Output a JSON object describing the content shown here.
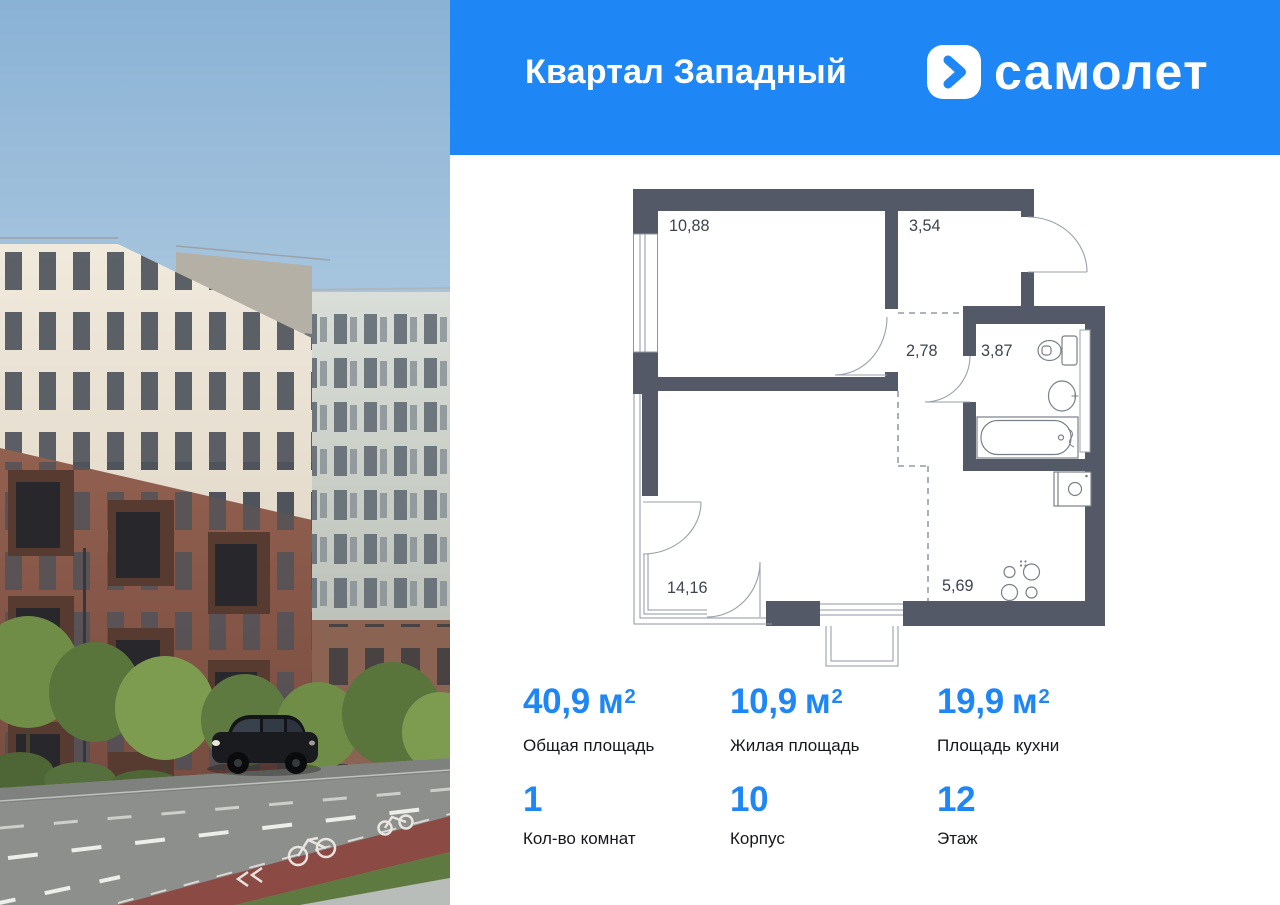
{
  "header": {
    "title": "Квартал Западный",
    "brand": "самолет"
  },
  "floor_plan": {
    "room_areas": [
      {
        "room": "bedroom",
        "area": "10,88"
      },
      {
        "room": "hallway",
        "area": "3,54"
      },
      {
        "room": "corridor",
        "area": "2,78"
      },
      {
        "room": "bathroom",
        "area": "3,87"
      },
      {
        "room": "living-room",
        "area": "14,16"
      },
      {
        "room": "kitchen",
        "area": "5,69"
      }
    ]
  },
  "stats": {
    "row1": [
      {
        "value": "40,9",
        "unit": "м",
        "sup": "2",
        "label": "Общая площадь"
      },
      {
        "value": "10,9",
        "unit": "м",
        "sup": "2",
        "label": "Жилая площадь"
      },
      {
        "value": "19,9",
        "unit": "м",
        "sup": "2",
        "label": "Площадь кухни"
      }
    ],
    "row2": [
      {
        "value": "1",
        "label": "Кол-во комнат"
      },
      {
        "value": "10",
        "label": "Корпус"
      },
      {
        "value": "12",
        "label": "Этаж"
      }
    ]
  },
  "colors": {
    "brand_blue": "#1E87F5",
    "plan_wall": "#535966",
    "plan_text": "#3E4350",
    "label_text": "#17181c"
  }
}
